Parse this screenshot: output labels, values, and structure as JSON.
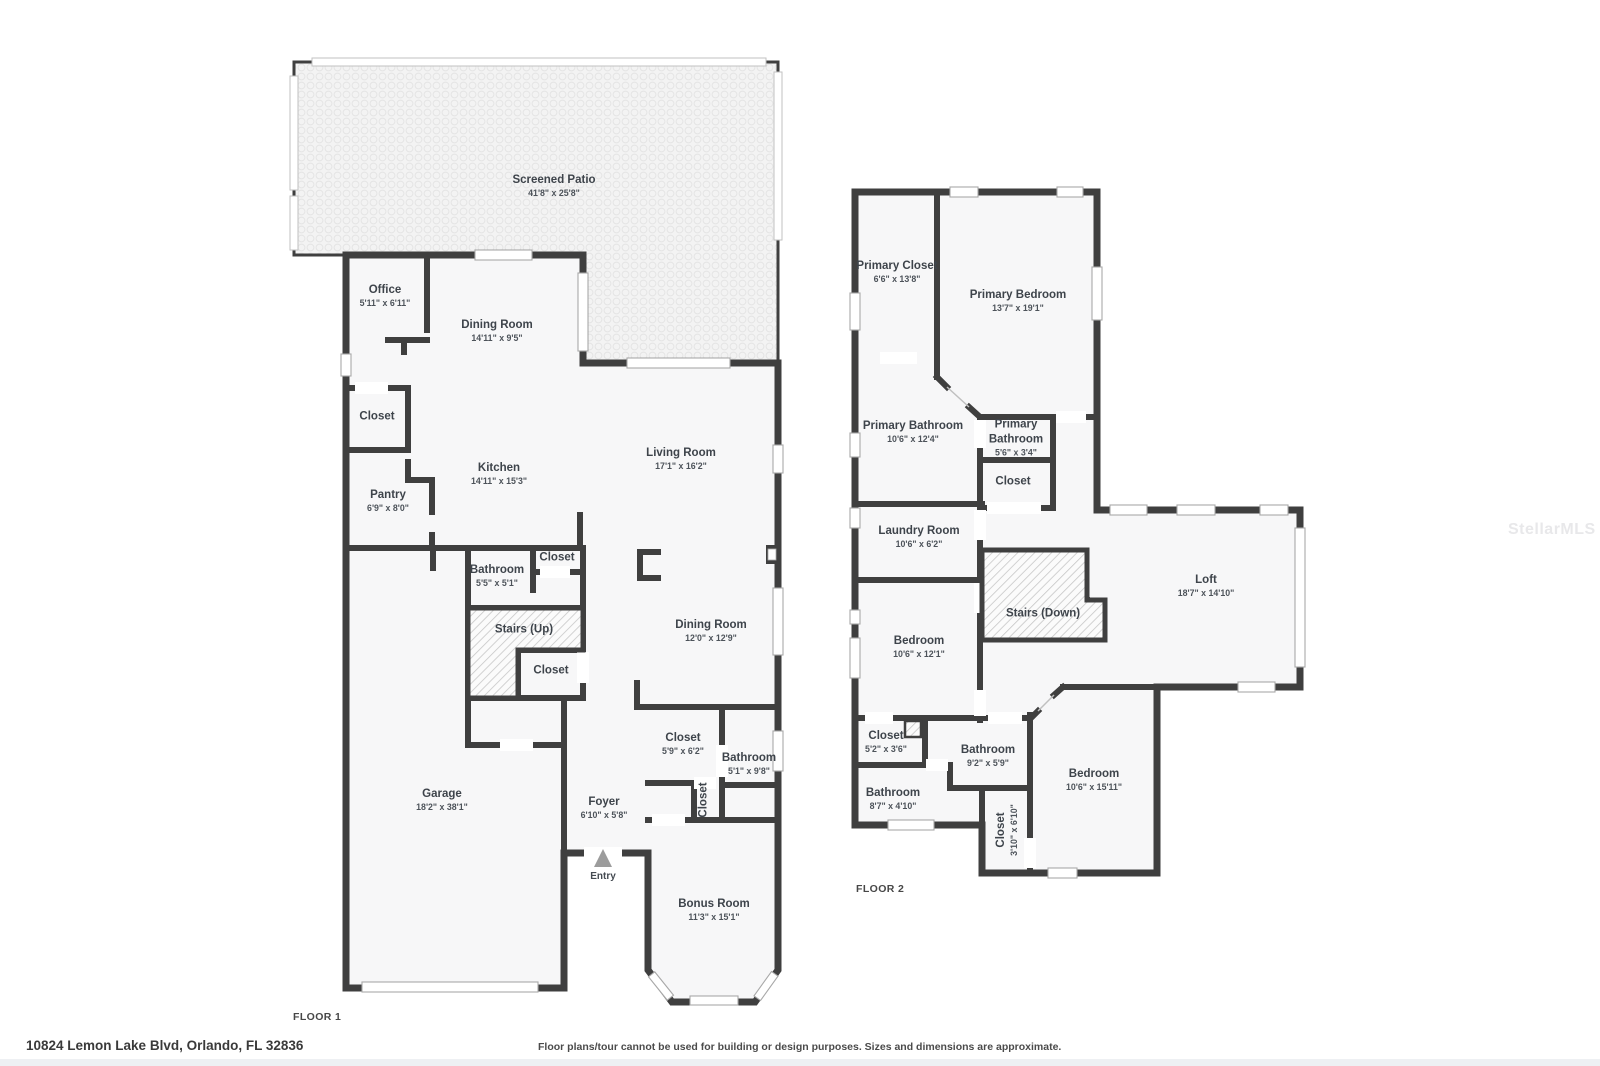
{
  "page": {
    "address": "10824 Lemon Lake Blvd, Orlando, FL 32836",
    "disclaimer": "Floor plans/tour cannot be used for building or design purposes. Sizes and dimensions are approximate.",
    "watermark": "StellarMLS",
    "colors": {
      "wall": "#3f3f3f",
      "room_fill": "#f7f7f8",
      "patio_fill": "#f3f3f3",
      "label_text": "#3e444b"
    }
  },
  "floor1": {
    "label": "FLOOR 1",
    "entry_label": "Entry",
    "rooms": [
      {
        "name": "Screened Patio",
        "dims": "41'8\" x 25'8\"",
        "x": 554,
        "y": 186
      },
      {
        "name": "Office",
        "dims": "5'11\" x 6'11\"",
        "x": 385,
        "y": 296
      },
      {
        "name": "Dining Room",
        "dims": "14'11\" x 9'5\"",
        "x": 497,
        "y": 331
      },
      {
        "name": "Closet",
        "x": 377,
        "y": 417
      },
      {
        "name": "Pantry",
        "dims": "6'9\" x 8'0\"",
        "x": 388,
        "y": 501
      },
      {
        "name": "Kitchen",
        "dims": "14'11\" x 15'3\"",
        "x": 499,
        "y": 474
      },
      {
        "name": "Living Room",
        "dims": "17'1\" x 16'2\"",
        "x": 681,
        "y": 459
      },
      {
        "name": "Bathroom",
        "dims": "5'5\" x 5'1\"",
        "x": 497,
        "y": 576
      },
      {
        "name": "Closet",
        "x": 557,
        "y": 558
      },
      {
        "name": "Stairs (Up)",
        "x": 524,
        "y": 630
      },
      {
        "name": "Closet",
        "x": 551,
        "y": 671
      },
      {
        "name": "Dining Room",
        "dims": "12'0\" x 12'9\"",
        "x": 711,
        "y": 631
      },
      {
        "name": "Garage",
        "dims": "18'2\" x 38'1\"",
        "x": 442,
        "y": 800
      },
      {
        "name": "Foyer",
        "dims": "6'10\" x 5'8\"",
        "x": 604,
        "y": 808
      },
      {
        "name": "Closet",
        "dims": "5'9\" x 6'2\"",
        "x": 683,
        "y": 744
      },
      {
        "name": "Bathroom",
        "dims": "5'1\" x 9'8\"",
        "x": 749,
        "y": 764
      },
      {
        "name": "Closet",
        "x": 704,
        "y": 800,
        "vertical": true
      },
      {
        "name": "Bonus Room",
        "dims": "11'3\" x 15'1\"",
        "x": 714,
        "y": 910
      }
    ]
  },
  "floor2": {
    "label": "FLOOR 2",
    "rooms": [
      {
        "name": "Primary Closet",
        "dims": "6'6\" x 13'8\"",
        "x": 897,
        "y": 272
      },
      {
        "name": "Primary Bedroom",
        "dims": "13'7\" x 19'1\"",
        "x": 1018,
        "y": 301
      },
      {
        "name": "Primary Bathroom",
        "dims": "10'6\" x 12'4\"",
        "x": 913,
        "y": 432
      },
      {
        "name": "Primary Bathroom",
        "dims": "5'6\" x 3'4\"",
        "x": 1016,
        "y": 438,
        "narrow": true
      },
      {
        "name": "Closet",
        "x": 1013,
        "y": 482
      },
      {
        "name": "Laundry Room",
        "dims": "10'6\" x 6'2\"",
        "x": 919,
        "y": 537
      },
      {
        "name": "Stairs (Down)",
        "x": 1043,
        "y": 614
      },
      {
        "name": "Loft",
        "dims": "18'7\" x 14'10\"",
        "x": 1206,
        "y": 586
      },
      {
        "name": "Bedroom",
        "dims": "10'6\" x 12'1\"",
        "x": 919,
        "y": 647
      },
      {
        "name": "Closet",
        "dims": "5'2\" x 3'6\"",
        "x": 886,
        "y": 742
      },
      {
        "name": "Bathroom",
        "dims": "9'2\" x 5'9\"",
        "x": 988,
        "y": 756
      },
      {
        "name": "Bathroom",
        "dims": "8'7\" x 4'10\"",
        "x": 893,
        "y": 799
      },
      {
        "name": "Closet",
        "dims": "3'10\" x 6'10\"",
        "x": 1007,
        "y": 830,
        "vertical": true
      },
      {
        "name": "Bedroom",
        "dims": "10'6\" x 15'11\"",
        "x": 1094,
        "y": 780
      }
    ]
  }
}
